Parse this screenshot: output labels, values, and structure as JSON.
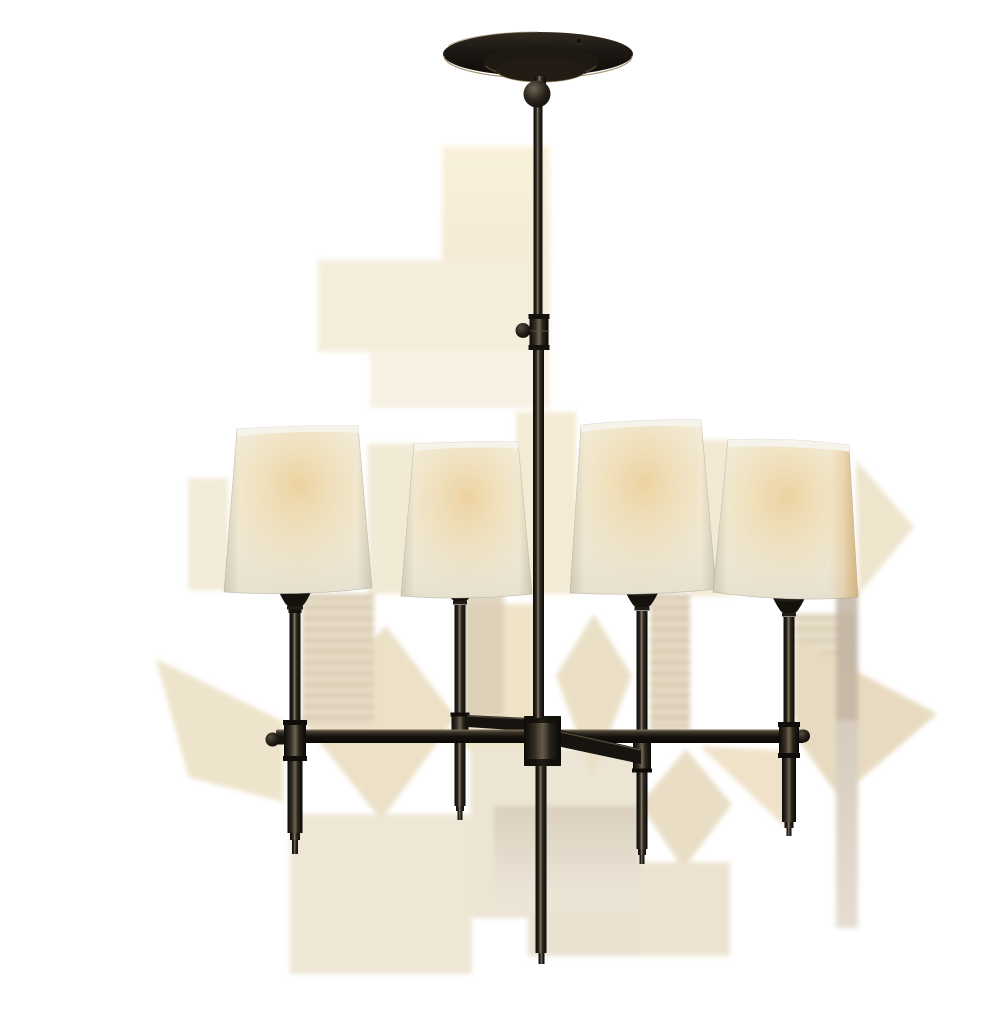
{
  "page": {
    "background": "#ffffff"
  },
  "product_image": {
    "subject": "Four-light chandelier with tapered natural-paper shades, dark bronze metalwork, round ceiling canopy, swivel ball, long center stem, cross arms with thumbscrew knobs and tapered drop finials",
    "light_count": 4,
    "shade_count": 4,
    "colors": {
      "background": "#ffffff",
      "metal_dark": "#17130e",
      "metal_darkest": "#0b0a07",
      "metal_highlight": "#8a7d63",
      "brass_accent": "#8d7a50",
      "shade_base": "#f1ebda",
      "shade_rim": "#f6f3ea",
      "shade_edge_shadow": "#aca592",
      "glow_warm": "#eccf9a",
      "glow_amber_edge": "#dba658",
      "shadow_cream": "#f3ecd8",
      "shadow_tan": "#d8cab0"
    }
  }
}
